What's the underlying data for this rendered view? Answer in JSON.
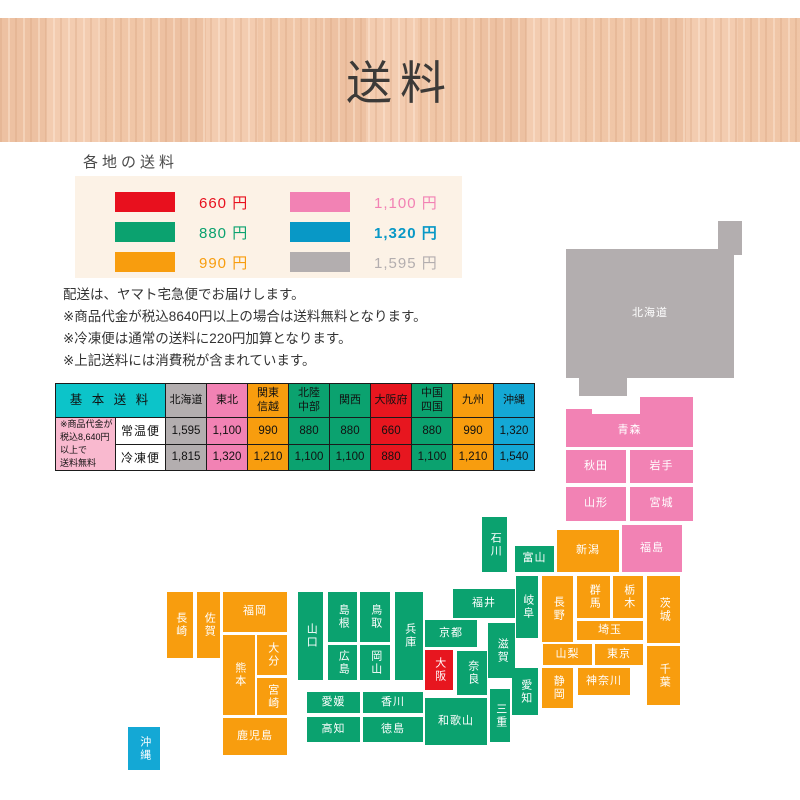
{
  "header": {
    "title": "送料"
  },
  "section": {
    "heading": "各地の送料"
  },
  "legend": {
    "items": [
      {
        "price": "660 円",
        "color": "#e8101e",
        "bold": false
      },
      {
        "price": "1,100 円",
        "color": "#f282b4",
        "bold": false
      },
      {
        "price": "880 円",
        "color": "#0ba26f",
        "bold": false
      },
      {
        "price": "1,320 円",
        "color": "#0898c6",
        "bold": true
      },
      {
        "price": "990 円",
        "color": "#f89d0e",
        "bold": false
      },
      {
        "price": "1,595 円",
        "color": "#b3aeaf",
        "bold": false
      }
    ]
  },
  "notes": {
    "line1": "配送は、ヤマト宅急便でお届けします。",
    "line2": "※商品代金が税込8640円以上の場合は送料無料となります。",
    "line3": "※冷凍便は通常の送料に220円加算となります。",
    "line4": "※上記送料には消費税が含まれています。"
  },
  "zone_colors": {
    "gray": "#b3aeaf",
    "pink": "#f282b4",
    "orange": "#f89d0e",
    "green": "#0ba26f",
    "red": "#e7161f",
    "blue": "#14a8d5",
    "cyan": "#0cc4c9",
    "notepink": "#f9b9cf"
  },
  "table": {
    "corner_label": "基 本 送 料",
    "free_note_lines": [
      "※商品代金が",
      "税込8,640円以上で",
      "送料無料"
    ],
    "columns": [
      {
        "id": "hokkaido",
        "label": "北海道",
        "zone": "gray"
      },
      {
        "id": "tohoku",
        "label": "東北",
        "zone": "pink"
      },
      {
        "id": "kanto-shinetsu",
        "label": "関東\n信越",
        "zone": "orange"
      },
      {
        "id": "hokuriku-chubu",
        "label": "北陸\n中部",
        "zone": "green"
      },
      {
        "id": "kansai",
        "label": "関西",
        "zone": "green"
      },
      {
        "id": "osaka-fu",
        "label": "大阪府",
        "zone": "red"
      },
      {
        "id": "chugoku-shikoku",
        "label": "中国\n四国",
        "zone": "green"
      },
      {
        "id": "kyushu",
        "label": "九州",
        "zone": "orange"
      },
      {
        "id": "okinawa",
        "label": "沖縄",
        "zone": "blue"
      }
    ],
    "rows": [
      {
        "label": "常温便",
        "values": [
          "1,595",
          "1,100",
          "990",
          "880",
          "880",
          "660",
          "880",
          "990",
          "1,320"
        ]
      },
      {
        "label": "冷凍便",
        "values": [
          "1,815",
          "1,320",
          "1,210",
          "1,100",
          "1,100",
          "880",
          "1,100",
          "1,210",
          "1,540"
        ]
      }
    ]
  },
  "map": {
    "prefectures": [
      {
        "id": "hokkaido",
        "name": "北海道",
        "x": 566,
        "y": 249,
        "w": 168,
        "h": 129,
        "zone": "gray",
        "v": false,
        "parts": [
          {
            "x": 718,
            "y": 221,
            "w": 24,
            "h": 34
          },
          {
            "x": 579,
            "y": 378,
            "w": 48,
            "h": 18
          }
        ]
      },
      {
        "id": "aomori",
        "name": "青森",
        "x": 566,
        "y": 414,
        "w": 127,
        "h": 33,
        "zone": "pink",
        "v": false,
        "parts": [
          {
            "x": 566,
            "y": 409,
            "w": 26,
            "h": 5
          },
          {
            "x": 640,
            "y": 397,
            "w": 53,
            "h": 17
          }
        ]
      },
      {
        "id": "akita",
        "name": "秋田",
        "x": 566,
        "y": 450,
        "w": 60,
        "h": 33,
        "zone": "pink",
        "v": false
      },
      {
        "id": "iwate",
        "name": "岩手",
        "x": 630,
        "y": 450,
        "w": 63,
        "h": 33,
        "zone": "pink",
        "v": false
      },
      {
        "id": "yamagata",
        "name": "山形",
        "x": 566,
        "y": 487,
        "w": 60,
        "h": 34,
        "zone": "pink",
        "v": false
      },
      {
        "id": "miyagi",
        "name": "宮城",
        "x": 630,
        "y": 487,
        "w": 63,
        "h": 34,
        "zone": "pink",
        "v": false
      },
      {
        "id": "fukushima",
        "name": "福島",
        "x": 622,
        "y": 525,
        "w": 60,
        "h": 47,
        "zone": "pink",
        "v": false
      },
      {
        "id": "niigata",
        "name": "新潟",
        "x": 557,
        "y": 530,
        "w": 62,
        "h": 42,
        "zone": "orange",
        "v": false
      },
      {
        "id": "ishikawa",
        "name": "石川",
        "x": 482,
        "y": 517,
        "w": 25,
        "h": 55,
        "zone": "green",
        "v": true
      },
      {
        "id": "toyama",
        "name": "富山",
        "x": 515,
        "y": 546,
        "w": 39,
        "h": 26,
        "zone": "green",
        "v": false
      },
      {
        "id": "fukui",
        "name": "福井",
        "x": 453,
        "y": 589,
        "w": 62,
        "h": 29,
        "zone": "green",
        "v": false
      },
      {
        "id": "gifu",
        "name": "岐阜",
        "x": 516,
        "y": 576,
        "w": 22,
        "h": 62,
        "zone": "green",
        "v": true
      },
      {
        "id": "nagano",
        "name": "長野",
        "x": 542,
        "y": 576,
        "w": 31,
        "h": 66,
        "zone": "orange",
        "v": true
      },
      {
        "id": "gunma",
        "name": "群馬",
        "x": 577,
        "y": 576,
        "w": 33,
        "h": 42,
        "zone": "orange",
        "v": true
      },
      {
        "id": "tochigi",
        "name": "栃木",
        "x": 613,
        "y": 576,
        "w": 30,
        "h": 42,
        "zone": "orange",
        "v": true
      },
      {
        "id": "ibaraki",
        "name": "茨城",
        "x": 647,
        "y": 576,
        "w": 33,
        "h": 67,
        "zone": "orange",
        "v": true
      },
      {
        "id": "saitama",
        "name": "埼玉",
        "x": 577,
        "y": 621,
        "w": 66,
        "h": 19,
        "zone": "orange",
        "v": false
      },
      {
        "id": "yamanashi",
        "name": "山梨",
        "x": 543,
        "y": 644,
        "w": 49,
        "h": 21,
        "zone": "orange",
        "v": false
      },
      {
        "id": "tokyo",
        "name": "東京",
        "x": 595,
        "y": 644,
        "w": 48,
        "h": 21,
        "zone": "orange",
        "v": false
      },
      {
        "id": "chiba",
        "name": "千葉",
        "x": 647,
        "y": 646,
        "w": 33,
        "h": 59,
        "zone": "orange",
        "v": true
      },
      {
        "id": "kanagawa",
        "name": "神奈川",
        "x": 578,
        "y": 668,
        "w": 52,
        "h": 27,
        "zone": "orange",
        "v": false
      },
      {
        "id": "shizuoka",
        "name": "静岡",
        "x": 542,
        "y": 668,
        "w": 31,
        "h": 40,
        "zone": "orange",
        "v": true
      },
      {
        "id": "aichi",
        "name": "愛知",
        "x": 512,
        "y": 668,
        "w": 26,
        "h": 47,
        "zone": "green",
        "v": true
      },
      {
        "id": "mie",
        "name": "三重",
        "x": 490,
        "y": 689,
        "w": 20,
        "h": 53,
        "zone": "green",
        "v": true
      },
      {
        "id": "shiga",
        "name": "滋賀",
        "x": 488,
        "y": 623,
        "w": 27,
        "h": 55,
        "zone": "green",
        "v": true
      },
      {
        "id": "kyoto",
        "name": "京都",
        "x": 425,
        "y": 620,
        "w": 52,
        "h": 27,
        "zone": "green",
        "v": false
      },
      {
        "id": "osaka",
        "name": "大阪",
        "x": 425,
        "y": 650,
        "w": 28,
        "h": 40,
        "zone": "red",
        "v": true
      },
      {
        "id": "wakayama",
        "name": "和歌山",
        "x": 425,
        "y": 698,
        "w": 62,
        "h": 47,
        "zone": "green",
        "v": false
      },
      {
        "id": "nara",
        "name": "奈良",
        "x": 457,
        "y": 651,
        "w": 30,
        "h": 44,
        "zone": "green",
        "v": true
      },
      {
        "id": "hyogo",
        "name": "兵庫",
        "x": 395,
        "y": 592,
        "w": 28,
        "h": 88,
        "zone": "green",
        "v": true
      },
      {
        "id": "tottori",
        "name": "鳥取",
        "x": 360,
        "y": 592,
        "w": 30,
        "h": 50,
        "zone": "green",
        "v": true
      },
      {
        "id": "shimane",
        "name": "島根",
        "x": 328,
        "y": 592,
        "w": 29,
        "h": 50,
        "zone": "green",
        "v": true
      },
      {
        "id": "okayama",
        "name": "岡山",
        "x": 360,
        "y": 645,
        "w": 30,
        "h": 35,
        "zone": "green",
        "v": true
      },
      {
        "id": "hiroshima",
        "name": "広島",
        "x": 328,
        "y": 645,
        "w": 29,
        "h": 35,
        "zone": "green",
        "v": true
      },
      {
        "id": "yamaguchi",
        "name": "山口",
        "x": 298,
        "y": 592,
        "w": 25,
        "h": 88,
        "zone": "green",
        "v": true
      },
      {
        "id": "ehime",
        "name": "愛媛",
        "x": 307,
        "y": 692,
        "w": 53,
        "h": 21,
        "zone": "green",
        "v": false
      },
      {
        "id": "kagawa",
        "name": "香川",
        "x": 363,
        "y": 692,
        "w": 60,
        "h": 21,
        "zone": "green",
        "v": false
      },
      {
        "id": "kochi",
        "name": "高知",
        "x": 307,
        "y": 717,
        "w": 53,
        "h": 25,
        "zone": "green",
        "v": false
      },
      {
        "id": "tokushima",
        "name": "徳島",
        "x": 363,
        "y": 717,
        "w": 60,
        "h": 25,
        "zone": "green",
        "v": false
      },
      {
        "id": "fukuoka",
        "name": "福岡",
        "x": 223,
        "y": 592,
        "w": 64,
        "h": 40,
        "zone": "orange",
        "v": false
      },
      {
        "id": "saga",
        "name": "佐賀",
        "x": 197,
        "y": 592,
        "w": 23,
        "h": 66,
        "zone": "orange",
        "v": true
      },
      {
        "id": "nagasaki",
        "name": "長崎",
        "x": 167,
        "y": 592,
        "w": 26,
        "h": 66,
        "zone": "orange",
        "v": true
      },
      {
        "id": "kumamoto",
        "name": "熊本",
        "x": 223,
        "y": 635,
        "w": 32,
        "h": 80,
        "zone": "orange",
        "v": true
      },
      {
        "id": "oita",
        "name": "大分",
        "x": 257,
        "y": 635,
        "w": 30,
        "h": 40,
        "zone": "orange",
        "v": true
      },
      {
        "id": "miyazaki",
        "name": "宮崎",
        "x": 257,
        "y": 678,
        "w": 30,
        "h": 37,
        "zone": "orange",
        "v": true
      },
      {
        "id": "kagoshima",
        "name": "鹿児島",
        "x": 223,
        "y": 718,
        "w": 64,
        "h": 37,
        "zone": "orange",
        "v": false
      },
      {
        "id": "okinawa",
        "name": "沖縄",
        "x": 128,
        "y": 727,
        "w": 32,
        "h": 43,
        "zone": "blue",
        "v": true
      }
    ]
  }
}
